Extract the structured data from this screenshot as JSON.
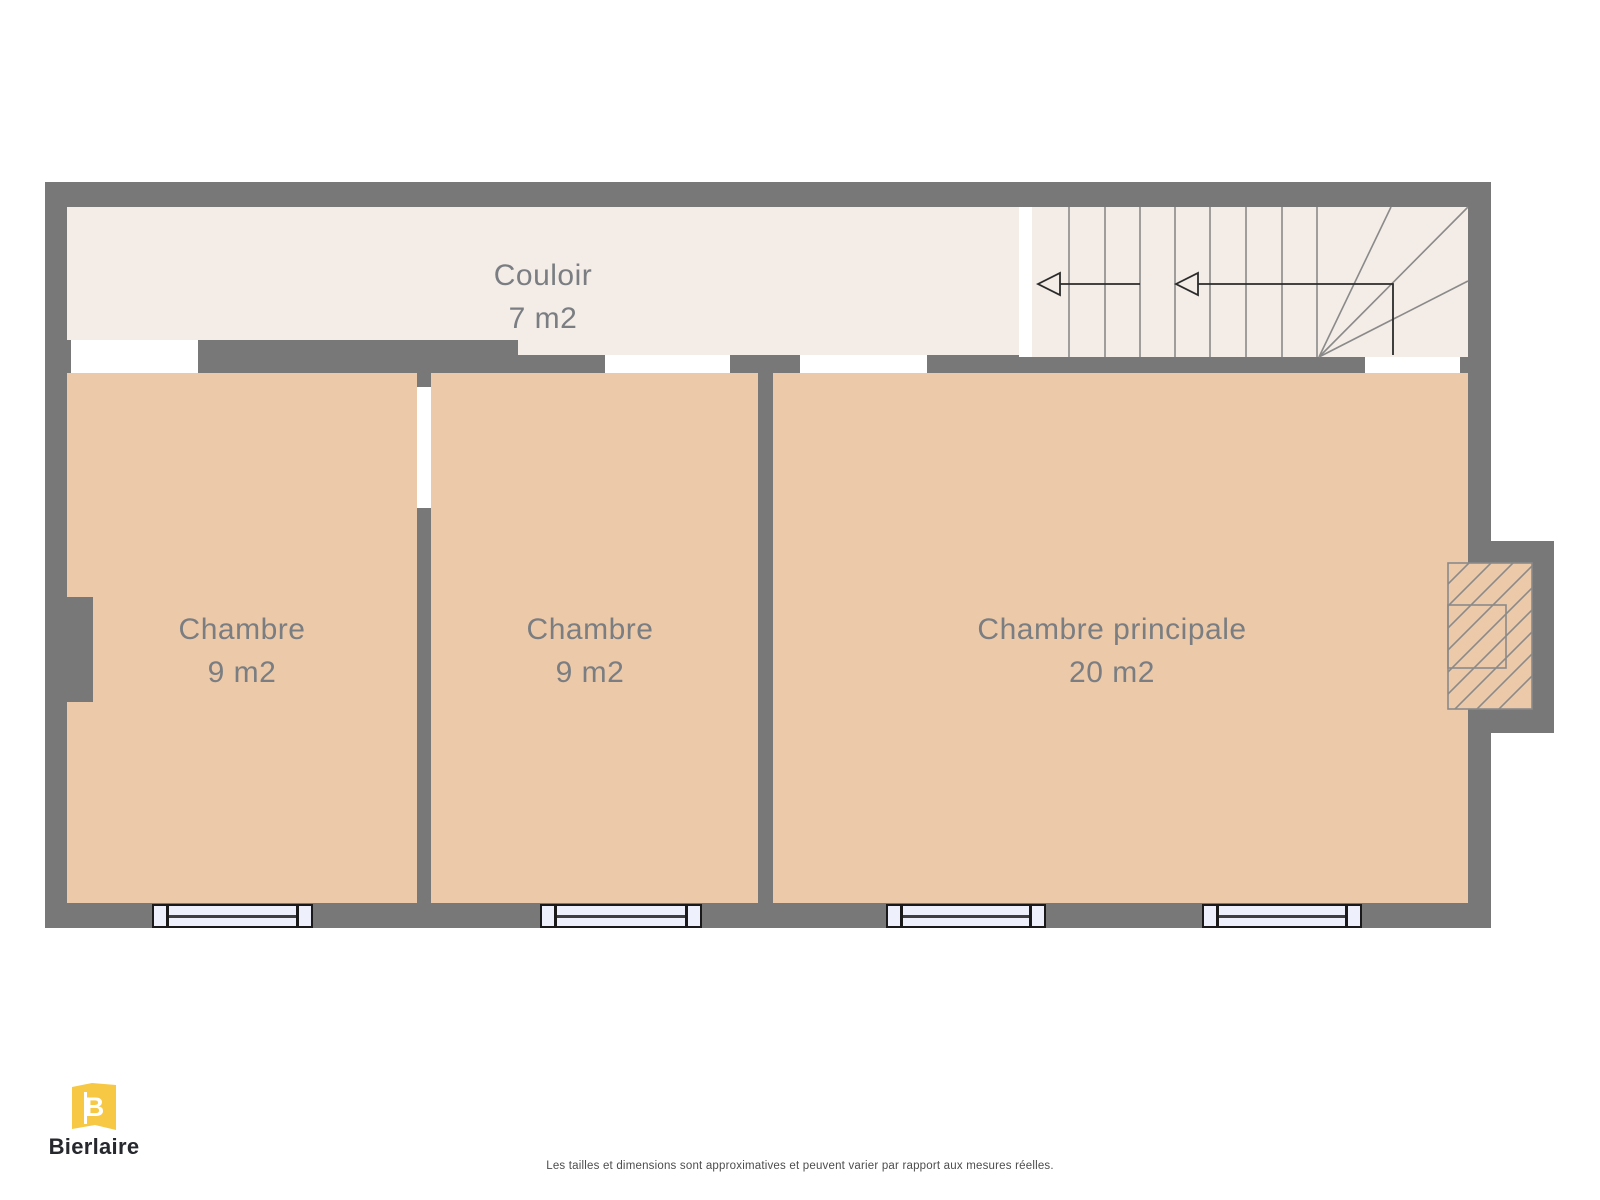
{
  "rooms": [
    {
      "id": "couloir",
      "name": "Couloir",
      "area": "7 m2"
    },
    {
      "id": "chambre-1",
      "name": "Chambre",
      "area": "9 m2"
    },
    {
      "id": "chambre-2",
      "name": "Chambre",
      "area": "9 m2"
    },
    {
      "id": "chambre-principale",
      "name": "Chambre principale",
      "area": "20 m2"
    }
  ],
  "colors": {
    "wall": "#787878",
    "room_floor": "#ecc9a8",
    "hall_floor": "#f3ece7",
    "window_fill": "#eef0fb",
    "stair_line": "#8a8a8a",
    "label_text": "#7a7e82",
    "brand_yellow": "#f6c843",
    "brand_text": "#26282e",
    "arrow": "#2b2b2b",
    "disclaimer_text": "#4d4d4d"
  },
  "icons": {
    "stairs": "stairs-icon",
    "direction_arrow": "direction-arrow-icon",
    "window": "window-icon",
    "chimney": "chimney-hatch-icon"
  },
  "footer": {
    "brand": "Bierlaire",
    "monogram": "B",
    "disclaimer": "Les tailles et dimensions sont approximatives et peuvent varier par rapport aux mesures réelles."
  }
}
